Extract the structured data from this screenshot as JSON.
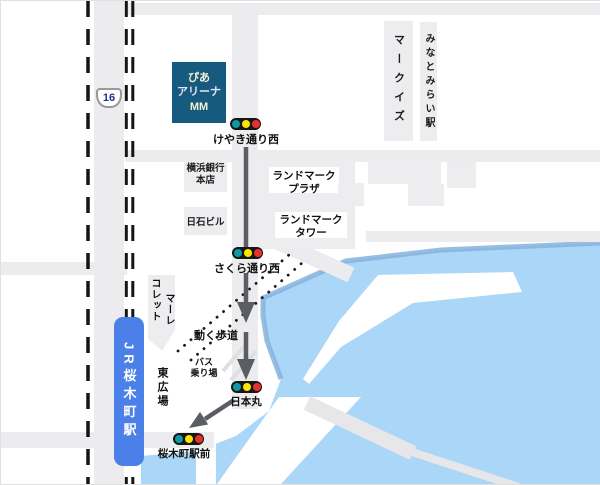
{
  "colors": {
    "water": "#aad6f8",
    "water_edge": "#86b2dd",
    "road": "#ececee",
    "building": "#ededef",
    "railway": "#151515",
    "route_arrow": "#5a5e64",
    "arena_bg": "#175a80",
    "jr_station_bg": "#4b80e8",
    "traffic_light_body": "#161616",
    "traffic_lamp_teal": "#0d9aa2",
    "traffic_lamp_yellow": "#ffe400",
    "traffic_lamp_red": "#e8312a",
    "route_shield_text": "#26338f"
  },
  "arena": {
    "lines": [
      "ぴあ",
      "アリーナ",
      "MM"
    ]
  },
  "jr_station": {
    "name": "JR桜木町駅"
  },
  "minatomirai_station": {
    "name": "みなとみらい駅"
  },
  "route_shield": {
    "number": "16"
  },
  "traffic_lights": [
    {
      "label": "けやき通り西"
    },
    {
      "label": "さくら通り西"
    },
    {
      "label": "日本丸"
    },
    {
      "label": "桜木町駅前"
    }
  ],
  "buildings": {
    "yokohama_bank": {
      "lines": [
        "横浜銀行",
        "本店"
      ]
    },
    "nisseki_building": {
      "name": "日石ビル"
    },
    "landmark_plaza": {
      "lines": [
        "ランドマーク",
        "プラザ"
      ]
    },
    "landmark_tower": {
      "lines": [
        "ランドマーク",
        "タワー"
      ]
    },
    "markis": {
      "name": "マークイズ"
    },
    "collet": {
      "name": "コレット"
    },
    "mare": {
      "name": "マーレ"
    }
  },
  "labels": {
    "moving_walkway": "動く歩道",
    "bus_stop": {
      "lines": [
        "バス",
        "乗り場"
      ]
    },
    "east_plaza": "東広場"
  }
}
